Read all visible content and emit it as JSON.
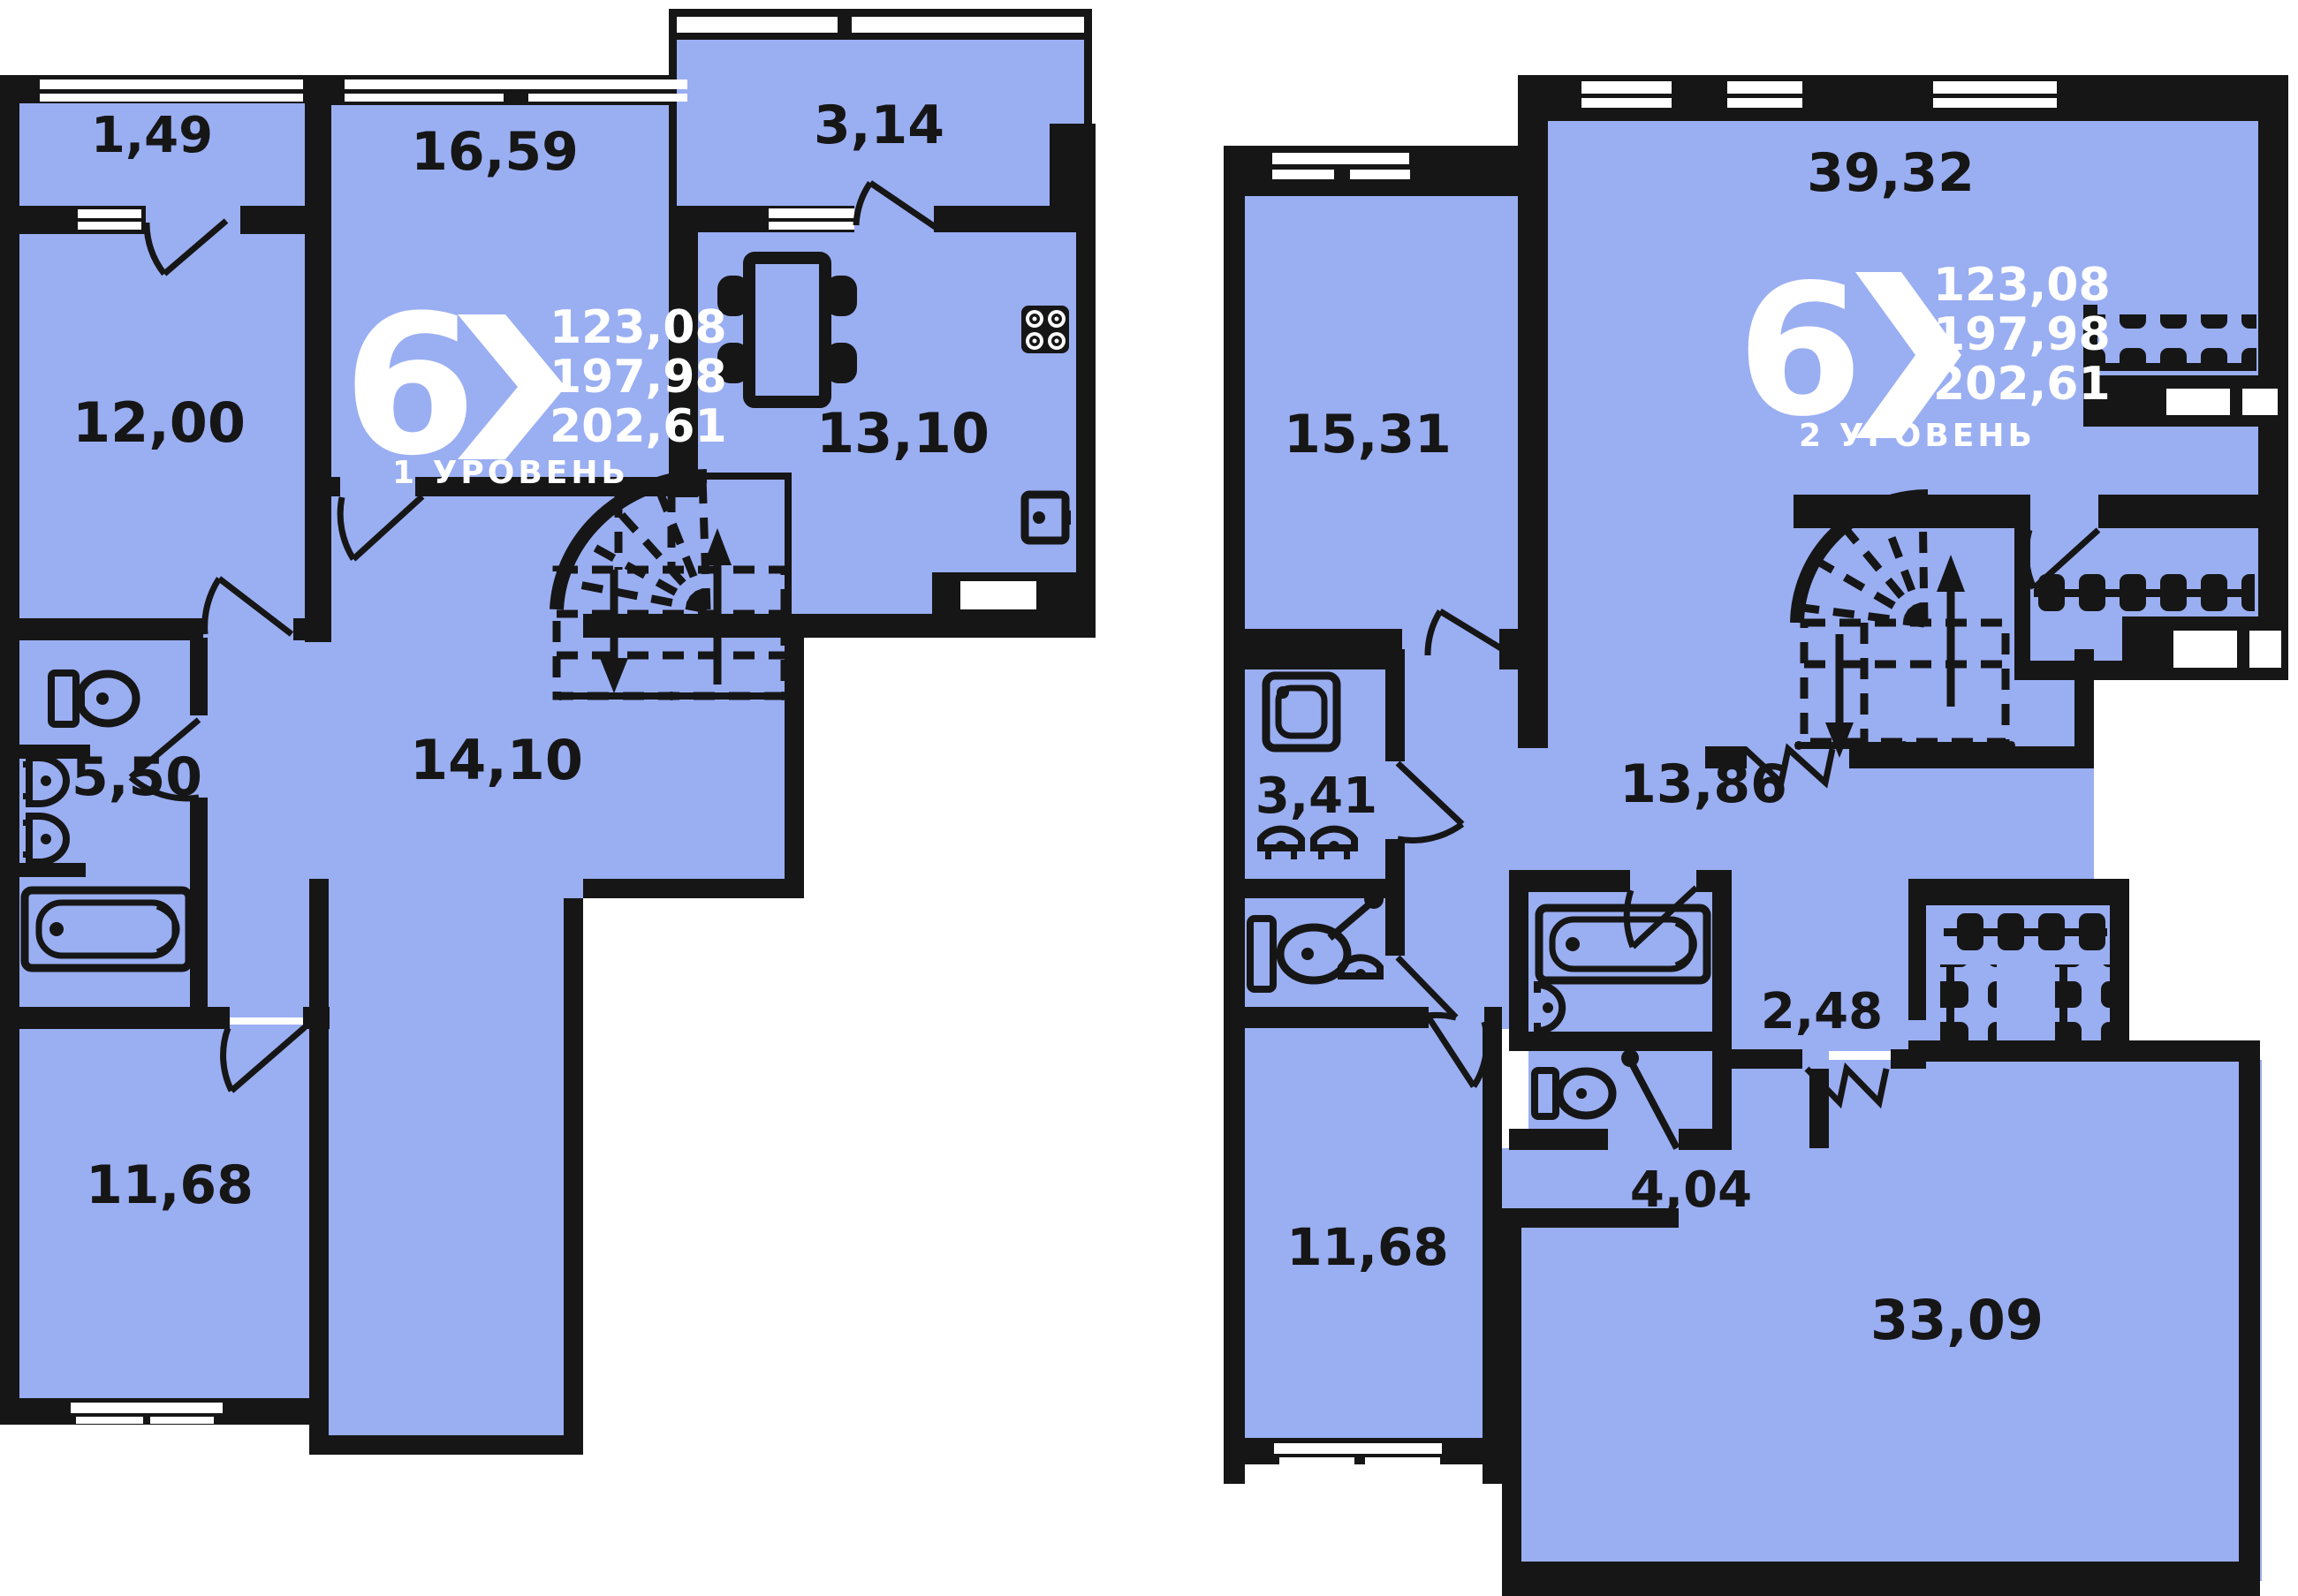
{
  "colors": {
    "room_fill": "#9aaef2",
    "wall": "#161616",
    "label_text": "#161616",
    "logo_text": "#ffffff",
    "background": "#ffffff"
  },
  "level1": {
    "logo": {
      "big_number": "6",
      "line1": "123,08",
      "line2": "197,98",
      "line3": "202,61",
      "level_label": "1 УРОВЕНЬ"
    },
    "areas": {
      "balcony": "1,49",
      "living_room": "16,59",
      "loggia": "3,14",
      "bedroom_left": "12,00",
      "kitchen": "13,10",
      "bathroom": "5,50",
      "hallway": "14,10",
      "bedroom_bottom": "11,68"
    }
  },
  "level2": {
    "logo": {
      "big_number": "6",
      "line1": "123,08",
      "line2": "197,98",
      "line3": "202,61",
      "level_label": "2 УРОВЕНЬ"
    },
    "areas": {
      "bedroom_left": "15,31",
      "living_room": "39,32",
      "shower_room": "3,41",
      "hallway": "13,86",
      "corridor": "2,48",
      "bedroom_bottom": "11,68",
      "bathroom_hall": "4,04",
      "master_bedroom": "33,09"
    }
  }
}
